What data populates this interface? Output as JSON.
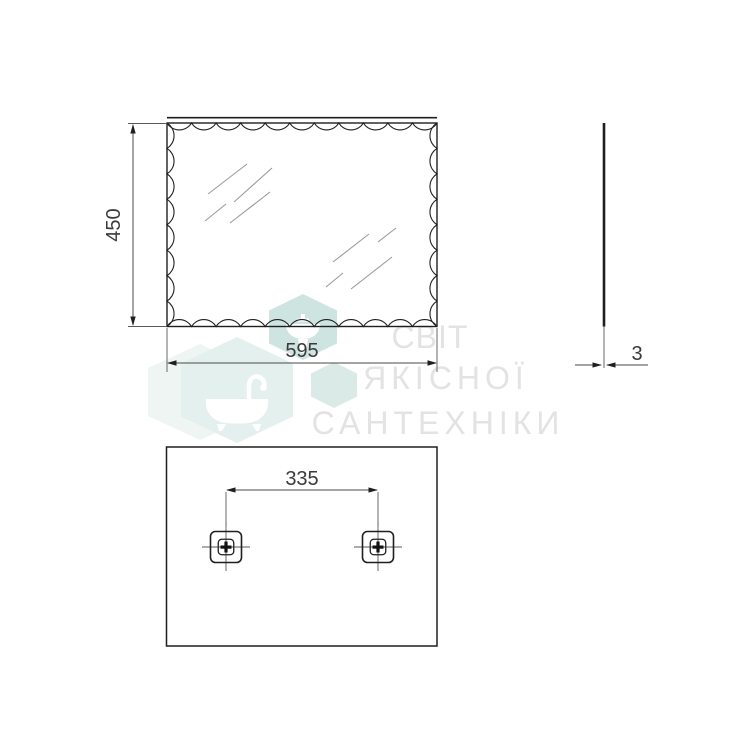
{
  "drawing": {
    "type": "technical-dimension-drawing",
    "subject": "rectangular mirror with scalloped edge, three orthographic views",
    "front_view": {
      "height_dim": "450",
      "width_dim": "595"
    },
    "side_view": {
      "thickness_dim": "3"
    },
    "rear_view": {
      "mount_spacing_dim": "335",
      "bracket_count": 2
    },
    "colors": {
      "object_line": "#1f1f1f",
      "dimension_line": "#4a4a4a",
      "label_text": "#3a3a3a",
      "reflection_line": "#9b9b9b"
    }
  },
  "watermark": {
    "line1": "СВІТ",
    "line2": "ЯКІСНОЇ",
    "line3": "САНТЕХНІКИ",
    "text_color": "#e3e3e3",
    "hex_color_dark": "#cee4e0",
    "hex_color_mid": "#d9eae7",
    "hex_color_light": "#e4f0ee",
    "hex_color_faint": "#eef5f3",
    "icon_color": "#ffffff",
    "icons": [
      "bathtub-icon",
      "sink-icon"
    ]
  }
}
